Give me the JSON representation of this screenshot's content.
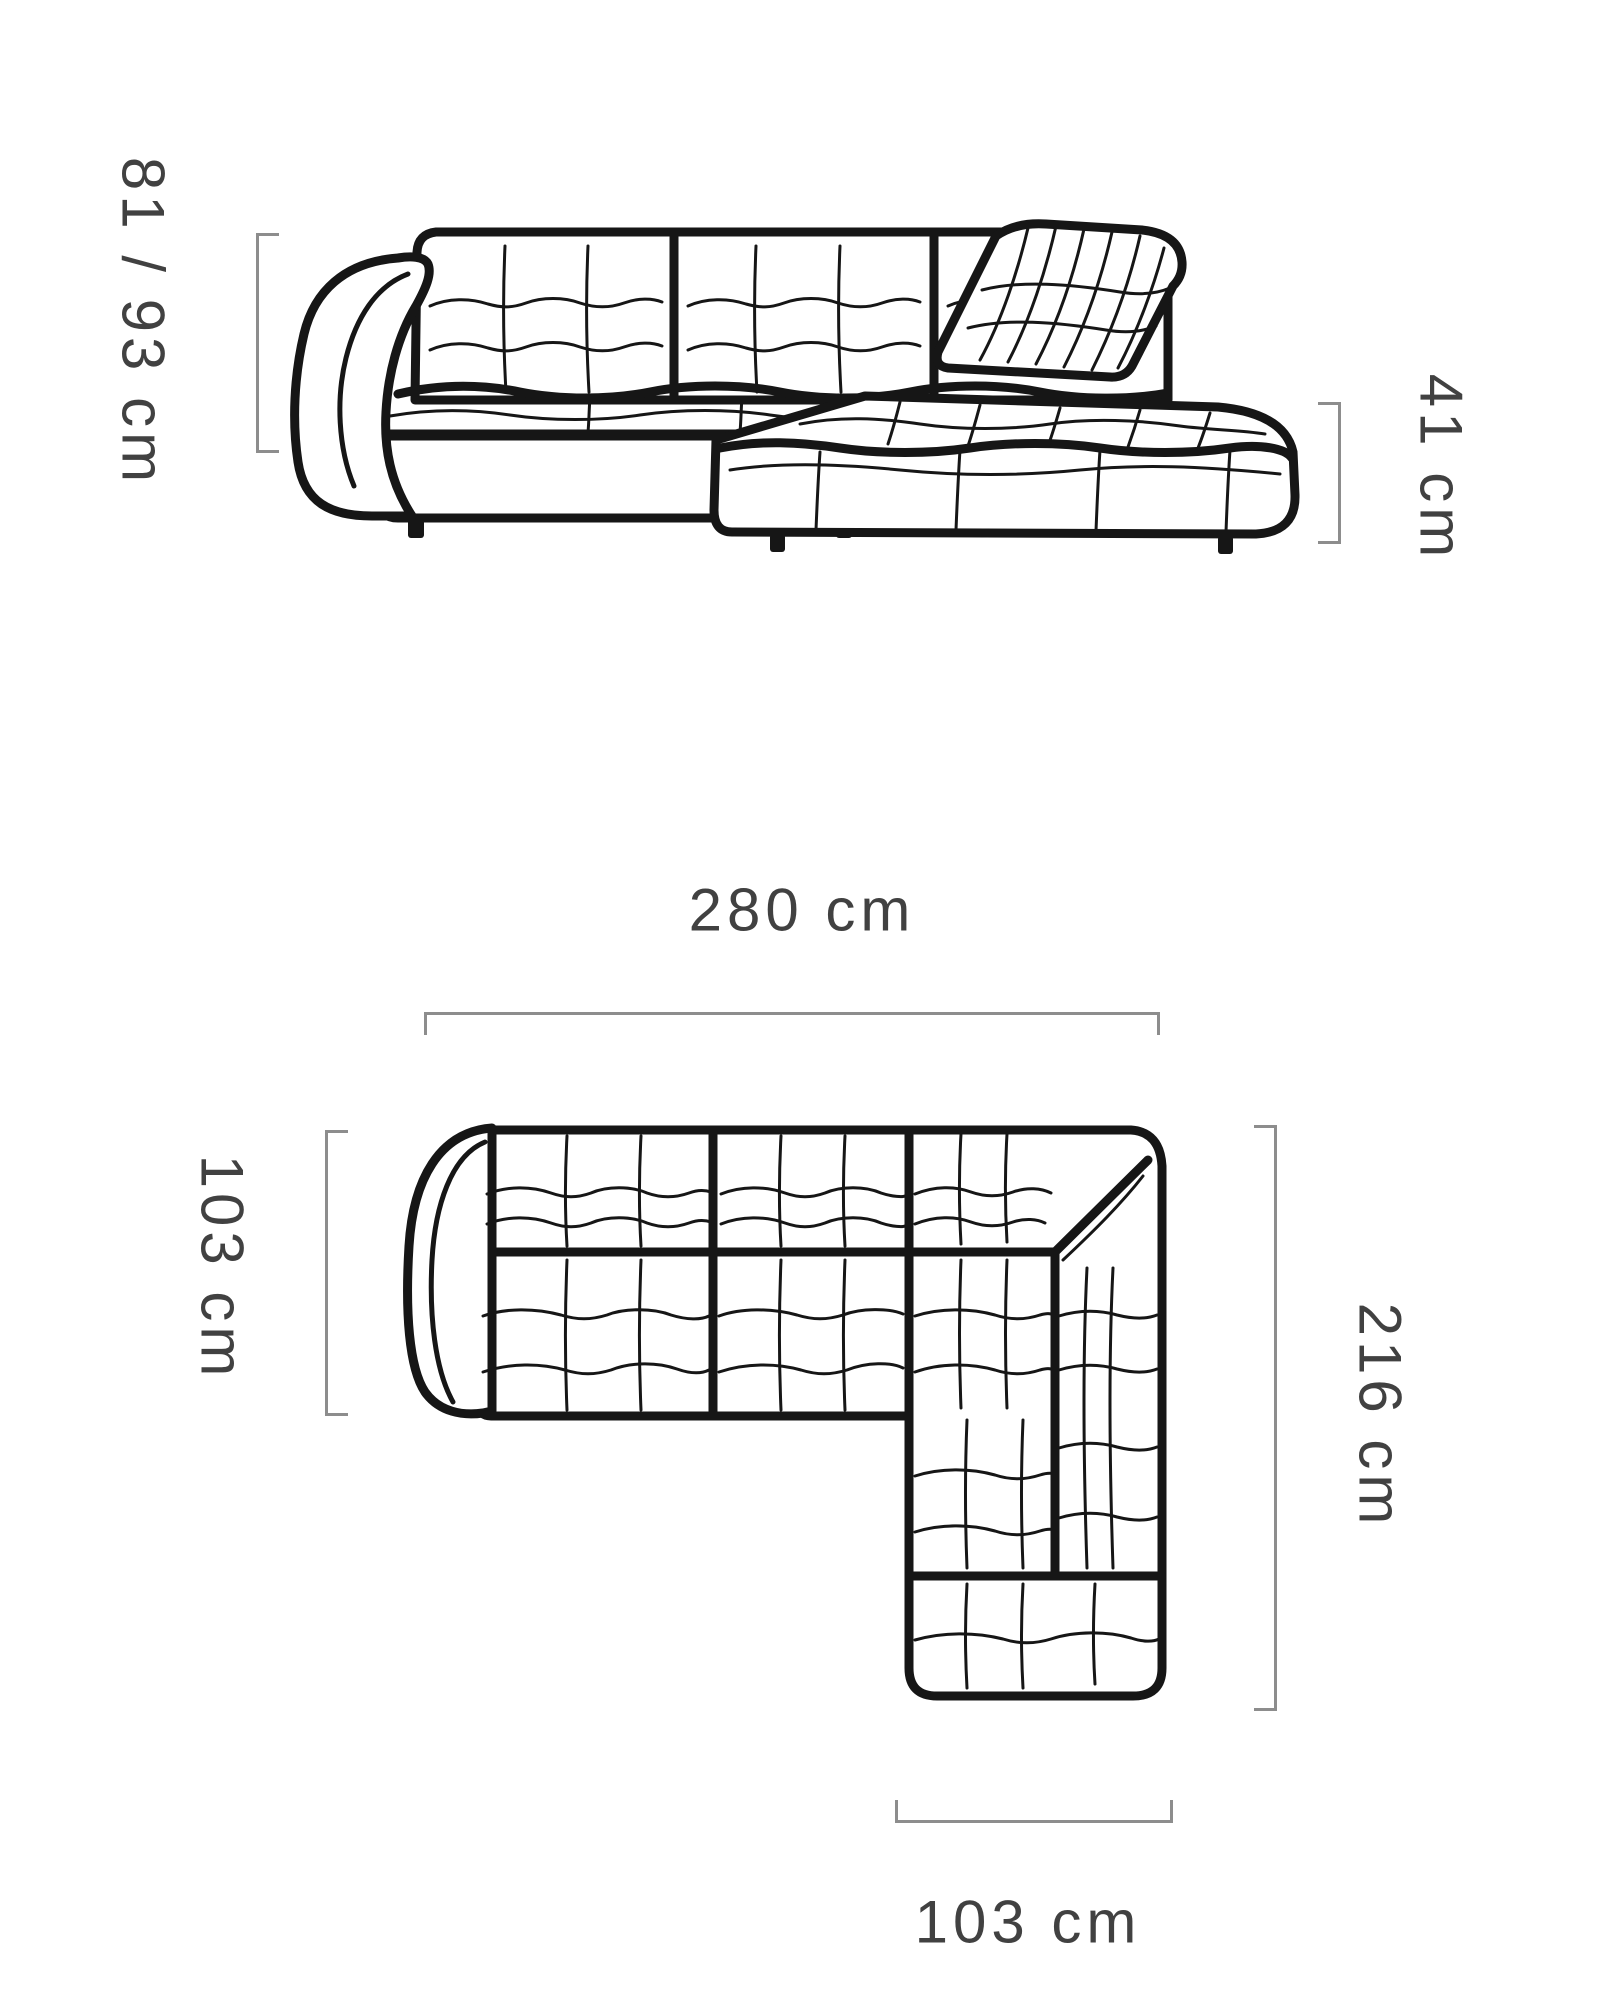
{
  "diagram": {
    "title": "corner-sofa-dimension-diagram",
    "background_color": "#ffffff",
    "line_color": "#161616",
    "bracket_color": "#8d8d8d",
    "label_color": "#414141"
  },
  "side_view": {
    "name": "sofa-side-elevation",
    "height_label": "81 / 93 cm",
    "seat_height_label": "41 cm"
  },
  "top_view": {
    "name": "sofa-top-plan",
    "width_label": "280 cm",
    "depth_label": "103 cm",
    "side_length_label": "216 cm",
    "chaise_width_label": "103 cm"
  }
}
